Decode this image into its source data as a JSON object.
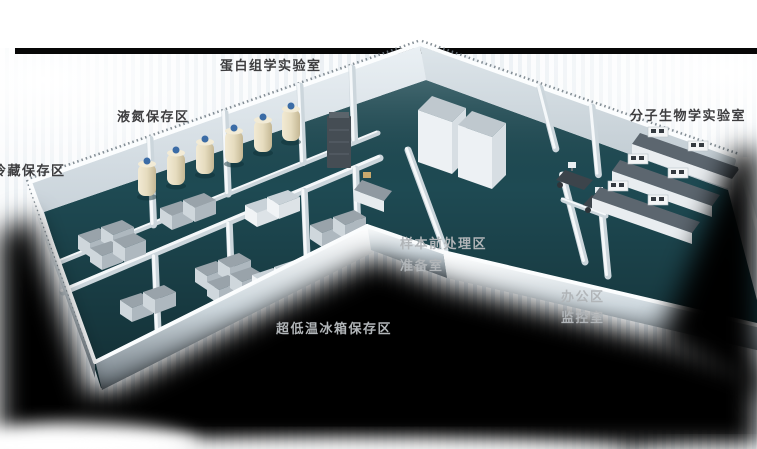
{
  "floorplan": {
    "labels": [
      {
        "id": "proteomics-lab",
        "text": "蛋白组学实验室",
        "tone": "dark"
      },
      {
        "id": "liquid-nitrogen-storage",
        "text": "液氮保存区",
        "tone": "dark"
      },
      {
        "id": "cold-storage",
        "text": "冷藏保存区",
        "tone": "dark"
      },
      {
        "id": "molecular-biology-lab",
        "text": "分子生物学实验室",
        "tone": "dark"
      },
      {
        "id": "sample-pretreatment-area",
        "text": "样本前处理区",
        "tone": "light"
      },
      {
        "id": "preparation-room",
        "text": "准备室",
        "tone": "light"
      },
      {
        "id": "office-area",
        "text": "办公区",
        "tone": "light"
      },
      {
        "id": "monitoring-room",
        "text": "监控室",
        "tone": "light"
      },
      {
        "id": "ult-freezer-storage",
        "text": "超低温冰箱保存区",
        "tone": "light"
      }
    ],
    "colors": {
      "floor": "#1e4a53",
      "wall": "#e9eff3",
      "wall_shade": "#c6d1d8",
      "equipment_top": "#99a3aa",
      "equipment_front": "#cfd7dc",
      "dewar": "#e8dfc4",
      "dewar_cap": "#3b6ca6",
      "bench_top": "#5c666f",
      "desk": "#3c444b",
      "shadow": "#000000",
      "label_dark": "#3e3e40",
      "label_light": "#b1b5b8"
    }
  }
}
